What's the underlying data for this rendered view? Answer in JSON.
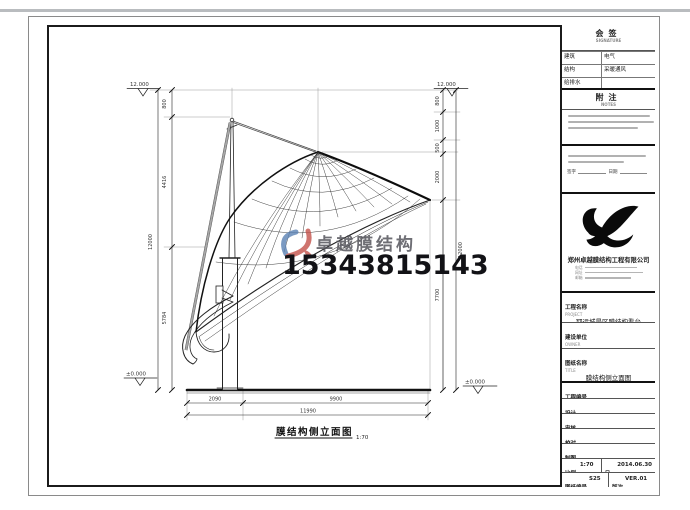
{
  "sheet": {
    "drawing_title": "膜结构侧立面图",
    "drawing_scale": "1:70"
  },
  "watermark": {
    "brand": "卓越膜结构",
    "phone": "15343815143"
  },
  "dimensions": {
    "left_outer": "12000",
    "left_chain": [
      "800",
      "4416",
      "5784"
    ],
    "right_chain": [
      "800",
      "1000",
      "500",
      "2000",
      "7700"
    ],
    "right_outer": "12000",
    "bottom_segments": [
      "2090",
      "9900"
    ],
    "bottom_total": "11990",
    "elevation_top_left": "12.000",
    "elevation_top_right": "12.000",
    "elevation_ground_left": "±0.000",
    "elevation_ground_right": "±0.000"
  },
  "title_block": {
    "countersign": {
      "label": "会签",
      "sublabel": "SIGNATURE",
      "rows": [
        [
          "建筑",
          "电气"
        ],
        [
          "结构",
          "采暖通风"
        ],
        [
          "给排水",
          ""
        ]
      ]
    },
    "notes": {
      "label": "附注",
      "sublabel": "NOTES"
    },
    "sign_line": {
      "sign": "签字",
      "date": "日期"
    },
    "company": {
      "name": "郑州卓越膜结构工程有限公司",
      "contact_labels": [
        "电话",
        "网址",
        "邮箱"
      ]
    },
    "fields": [
      {
        "label": "工程名称",
        "sublabel": "PROJECT",
        "value": "郓运城景区膜结构看台"
      },
      {
        "label": "建设单位",
        "sublabel": "OWNER",
        "value": ""
      },
      {
        "label": "图纸名称",
        "sublabel": "TITLE",
        "value": "膜结构侧立面图"
      },
      {
        "label": "工程编号",
        "sublabel": "CONTRACT No.",
        "value": ""
      },
      {
        "label": "设计",
        "sublabel": "DESIGNED",
        "value": ""
      },
      {
        "label": "审核",
        "sublabel": "CHECKED",
        "value": ""
      },
      {
        "label": "校对",
        "sublabel": "PROOFREAD",
        "value": ""
      },
      {
        "label": "制图",
        "sublabel": "DRAWN",
        "value": ""
      }
    ],
    "scale": {
      "label": "比例",
      "sublabel": "SCALE",
      "value": "1:70"
    },
    "date": {
      "label": "日期",
      "sublabel": "DATE",
      "value": "2014.06.30"
    },
    "dwg_no": {
      "label": "图纸编号",
      "sublabel": "DWG No.",
      "value": "S25"
    },
    "version": {
      "label": "版次",
      "sublabel": "VER.",
      "value": "VER.01"
    }
  },
  "colors": {
    "line": "#222222",
    "accent_blue": "#5b82b4",
    "accent_red": "#c4524a",
    "border": "#1b1b1b"
  }
}
